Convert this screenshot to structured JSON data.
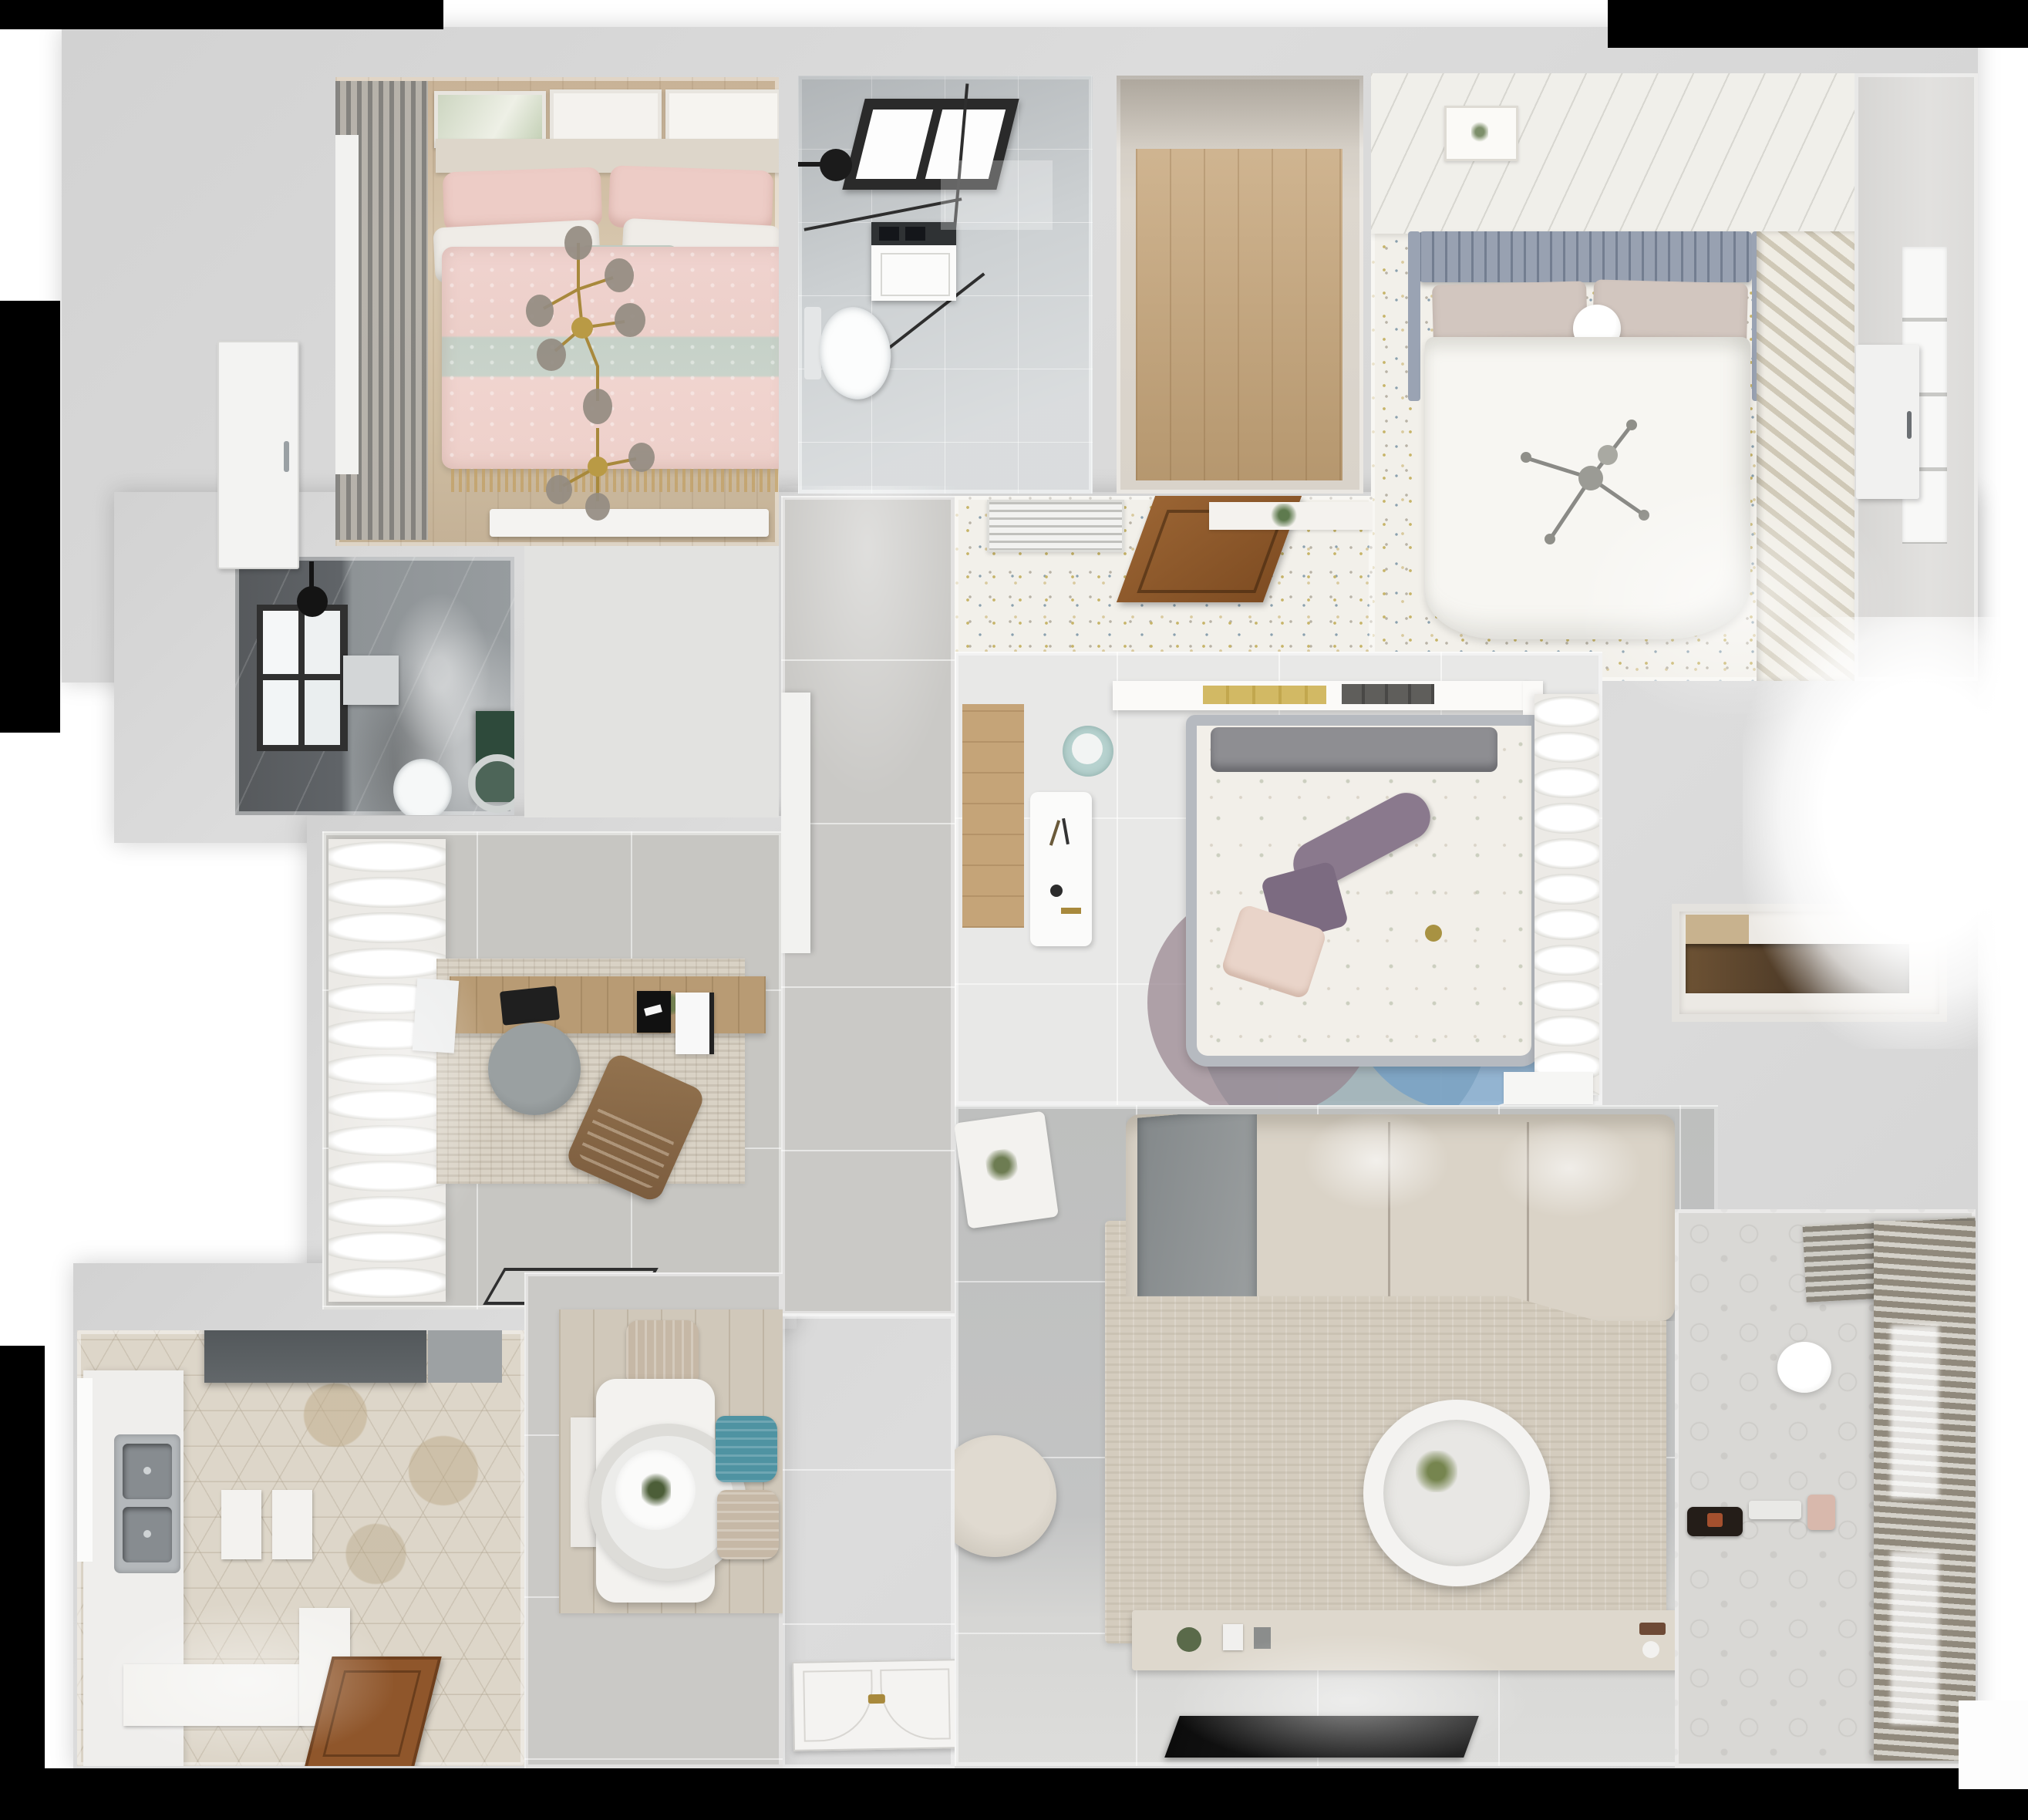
{
  "meta": {
    "description": "Top-down 3D rendered floor plan of a three-bedroom apartment, photoreal dollhouse view on white background with black transparency margins",
    "view": "top-down orthographic render",
    "visible_text": ""
  },
  "palette": {
    "mask": "#000000",
    "wall": "#d2d2d2",
    "wood1": "#d2bfa4",
    "tileGray": "#cdd1d3",
    "dotFloor": "#f2f0ea",
    "darkBath": "#5d6164",
    "studyTile": "#c7c6c2",
    "corridorTile": "#cac9c6",
    "bed3Floor": "#e8e8e7",
    "livingTile": "#bebfbe",
    "kitchenHex": "#ddd6c9",
    "diningTile": "#cac9c6",
    "balconyFloor": "#d9d8d5",
    "woodDoor": "#8f562b",
    "accentPink": "#edccc6",
    "accentMint": "#c5d0c7",
    "accentTeal": "#4f93a2",
    "accentGreen": "#2e4a3b",
    "headboardBlue": "#98a1b1",
    "sofaBeige": "#dad3c7",
    "rugBeige": "#d4ccbe",
    "closetWood": "#c5a478",
    "glassBlack": "#2a2a2a",
    "goldBrass": "#a8893c"
  },
  "rooms": [
    {
      "id": "bedroom-pink",
      "name": "Bedroom 1 - pink bed with brass branch chandelier",
      "furniture": [
        "double bed with pink patterned duvet",
        "mint throw band",
        "pink and white pillows",
        "picture frames",
        "gray striped curtain",
        "white dresser"
      ]
    },
    {
      "id": "bathroom-top",
      "name": "Bathroom 1 - shower room with skylight",
      "furniture": [
        "black framed skylight",
        "black shower head",
        "glass shower screen",
        "washing machine",
        "toilet"
      ]
    },
    {
      "id": "closet-top",
      "name": "Walk-in closet / laundry nook with wood floor",
      "furniture": []
    },
    {
      "id": "bedroom-white",
      "name": "Bedroom 2 - white bed on confetti-dot floor",
      "furniture": [
        "blue-gray tufted headboard",
        "white duvet",
        "beige pillows",
        "ball lamp",
        "stick chandelier",
        "slatted wardrobe",
        "air vent",
        "open wooden door"
      ]
    },
    {
      "id": "window-strip-right",
      "name": "Right window strip with white door",
      "furniture": [
        "window",
        "white door"
      ]
    },
    {
      "id": "bathroom-dark",
      "name": "Bathroom 2 - dark tiled with green vanity",
      "furniture": [
        "window",
        "black shower head",
        "toilet",
        "green vanity with round basin",
        "wall niche"
      ]
    },
    {
      "id": "study",
      "name": "Study with desk and lounge chair",
      "furniture": [
        "white wavy curtains",
        "textured rug",
        "wooden desk",
        "monitor",
        "laptop",
        "round gray chair",
        "brown lounge chair",
        "door mat"
      ]
    },
    {
      "id": "corridor",
      "name": "Central corridor with gray tiles",
      "furniture": [
        "white hallway cabinet"
      ]
    },
    {
      "id": "entry",
      "name": "Entry with ornate front door",
      "furniture": [
        "decorative white entry door with brass handles"
      ]
    },
    {
      "id": "bedroom-center",
      "name": "Bedroom 3 - floral duvet and round rugs",
      "furniture": [
        "bed with gray rails",
        "purple pillows",
        "blush pillow",
        "wall shelf with books",
        "two mint poufs",
        "white desk",
        "overlapping round rugs",
        "white curtains"
      ]
    },
    {
      "id": "living-room",
      "name": "Living room",
      "furniture": [
        "corner sofa with gray blanket",
        "side table with plant",
        "large beige rug",
        "round white coffee table",
        "armchair",
        "TV console",
        "flat TV"
      ]
    },
    {
      "id": "kitchen",
      "name": "Kitchen with hexagon tile floor",
      "furniture": [
        "range hood",
        "counter with double stainless sink",
        "window",
        "island cabinets",
        "L-counter",
        "wooden door"
      ]
    },
    {
      "id": "dining",
      "name": "Dining area",
      "furniture": [
        "white table",
        "ring pendant lamp with plant",
        "beige chair",
        "teal chair",
        "beige chair",
        "white bench",
        "wood plank floor"
      ]
    },
    {
      "id": "balcony",
      "name": "Balcony / play corner with venetian blinds",
      "furniture": [
        "venetian blinds",
        "round ceiling lamp",
        "toy kart",
        "small white bench",
        "pink bag"
      ]
    },
    {
      "id": "storage-niche",
      "name": "Hallway storage niche with dark wood shelf",
      "furniture": [
        "dark wood shelf"
      ]
    }
  ]
}
